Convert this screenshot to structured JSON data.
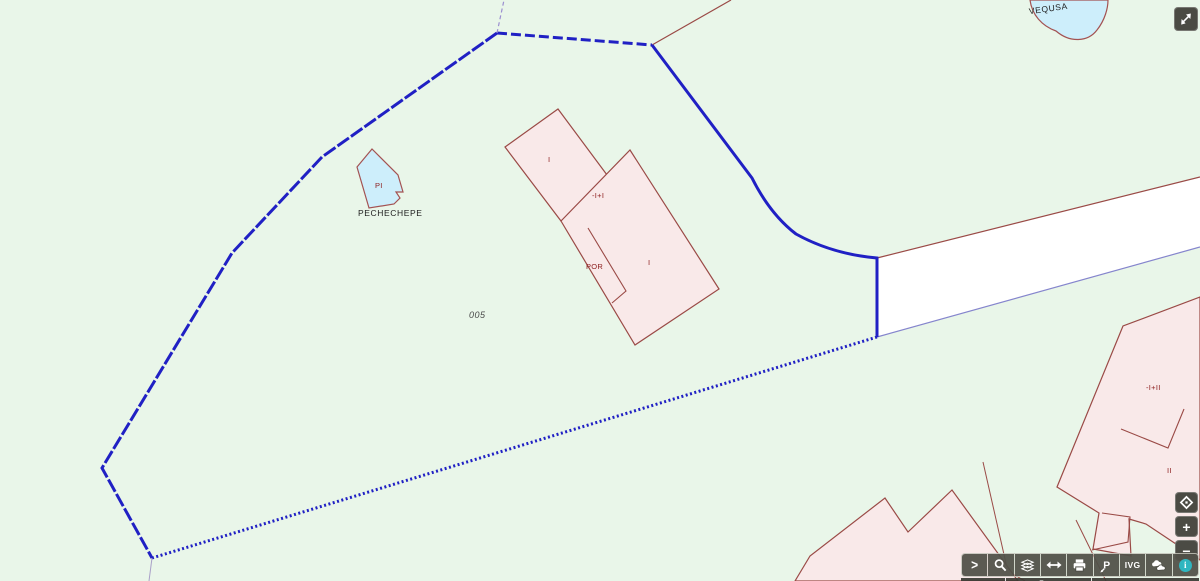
{
  "map_labels": {
    "parcel_number": "005",
    "water_top": "VEQUSA",
    "pond_code": "PI",
    "pond_name": "PECHECHEPE",
    "bldg_a_unit": "I",
    "bldg_main_floors": "-I+I",
    "bldg_wing": "POR",
    "bldg_main_unit": "I",
    "bldg_right_floors": "-I+II",
    "bldg_right_unit": "II"
  },
  "controls": {
    "expand_label": ">",
    "ivg_label": "IVG",
    "info_glyph": "i",
    "zoom_in_label": "+",
    "zoom_out_label": "−"
  },
  "scalebar": {
    "distance_label": "5 m"
  },
  "icons": {
    "fullscreen": "diagonal-double-arrow",
    "pan": "move-diamond",
    "search": "magnifier",
    "layers": "layer-stack",
    "measure": "horizontal-double-arrow",
    "print": "printer",
    "pin": "p-pin",
    "overlay": "clouds",
    "info": "info-circle"
  },
  "colors": {
    "map_background": "#e9f6e9",
    "selection_blue": "#2020c4",
    "building_fill": "#f9e9e9",
    "building_outline": "#9a4a46",
    "water_fill": "#cdeefb",
    "road_fill": "#ffffff",
    "toolbar_dark": "#4b4b44",
    "info_teal": "#2fb6c0"
  }
}
